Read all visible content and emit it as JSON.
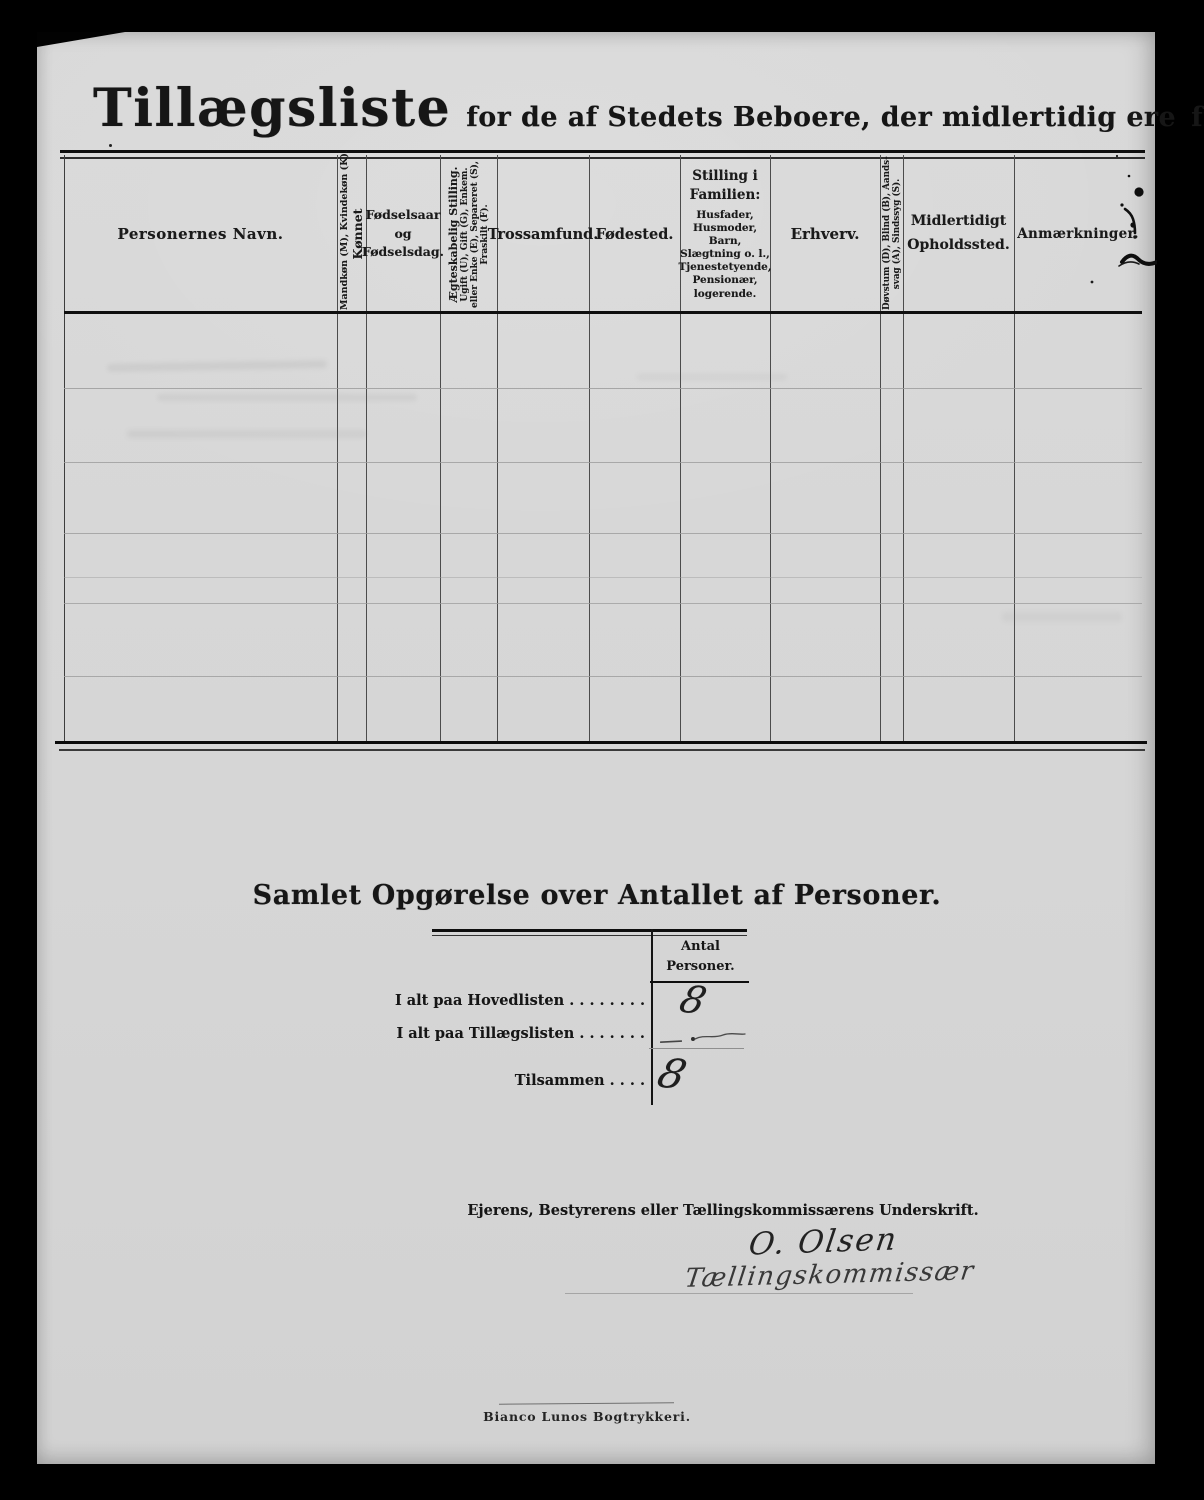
{
  "colors": {
    "background": "#000000",
    "paper": "#d7d7d7",
    "ink": "#161616"
  },
  "header": {
    "title": "Tillægsliste",
    "subtitle": "for de af Stedets Beboere, der midlertidig ere",
    "subtitle_emphasis": "fraværende."
  },
  "table": {
    "columns": {
      "name": "Personernes Navn.",
      "sex_main": "Kønnet",
      "sex_sub": "Mandkøn (M), Kvindekøn (K).",
      "birth": "Fødselsaar og Fødselsdag.",
      "marital_main": "Ægteskabelig Stilling.",
      "marital_sub1": "Ugift (U), Gift (G), Enkem.",
      "marital_sub2": "eller Enke (E), Separeret (S),",
      "marital_sub3": "Fraskilt (F).",
      "faith": "Trossamfund.",
      "birthplace": "Fødested.",
      "family_main": "Stilling i Familien:",
      "family_sub": "Husfader, Husmoder, Barn, Slægtning o. l., Tjenestetyende, Pensionær, logerende.",
      "occupation": "Erhverv.",
      "disability_line1": "Døvstum (D), Blind (B), Aands-",
      "disability_line2": "svag (A), Sindssyg (S).",
      "stay": "Midlertidigt Opholdssted.",
      "remarks": "Anmærkninger."
    }
  },
  "summary": {
    "heading": "Samlet Opgørelse over Antallet af Personer.",
    "count_header_line1": "Antal",
    "count_header_line2": "Personer.",
    "rows": [
      {
        "label": "I alt paa Hovedlisten",
        "leader": ". . . . . . . .",
        "value": "8"
      },
      {
        "label": "I alt paa Tillægslisten",
        "leader": ". . . . . . .",
        "value": "—"
      },
      {
        "label": "Tilsammen",
        "leader": ". . . .",
        "value": "8"
      }
    ]
  },
  "signature": {
    "label": "Ejerens, Bestyrerens eller Tællingskommissærens Underskrift.",
    "name": "O. Olsen",
    "role": "Tællingskommissær"
  },
  "footer": {
    "printer": "Bianco Lunos Bogtrykkeri."
  }
}
